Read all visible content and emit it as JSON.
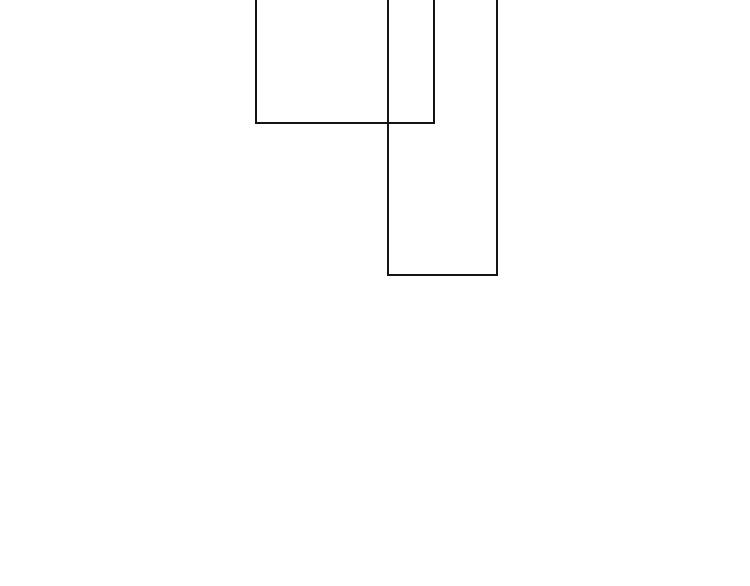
{
  "canvas": {
    "width": 750,
    "height": 586,
    "background_color": "#ffffff"
  },
  "shapes": [
    {
      "id": "rect-left",
      "type": "rectangle",
      "fill": "none",
      "stroke_color": "#141414",
      "stroke_width": 2,
      "left": 255,
      "top": -6,
      "width": 180,
      "height": 130,
      "top_edge_visible": false
    },
    {
      "id": "rect-right",
      "type": "rectangle",
      "fill": "none",
      "stroke_color": "#141414",
      "stroke_width": 2,
      "left": 387,
      "top": -6,
      "width": 111,
      "height": 282,
      "top_edge_visible": false
    }
  ]
}
